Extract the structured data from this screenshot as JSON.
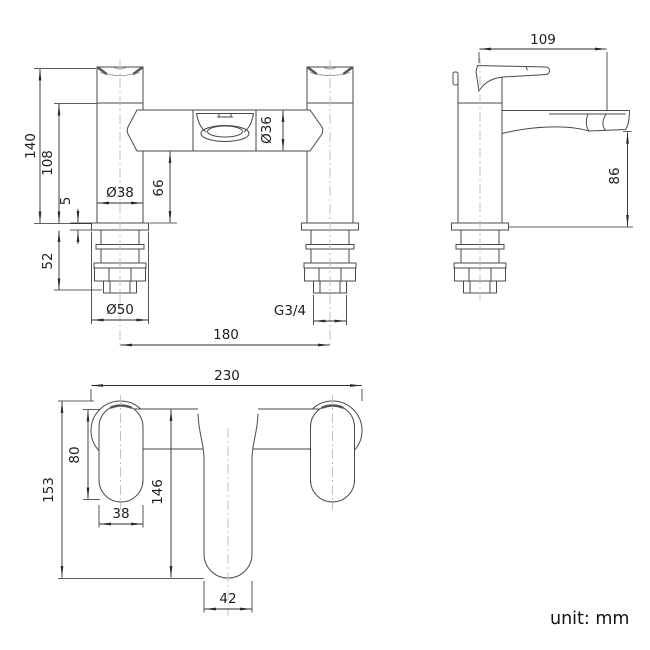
{
  "drawing_type": "tap-technical-drawing",
  "unit_note": "unit: mm",
  "colors": {
    "background": "#ffffff",
    "outline": "#4a4a4a",
    "dimension": "#2b2b2b",
    "centerline": "#bcbcbc",
    "text": "#1c1c1c"
  },
  "views": {
    "front": {
      "labels": {
        "total_height": "140",
        "body_height": "108",
        "deck_plate_thickness": "5",
        "shank_length": "52",
        "pillar_diameter": "Ø38",
        "under_body_height": "66",
        "body_diameter": "Ø36",
        "flange_diameter": "Ø50",
        "thread_size": "G3/4",
        "tap_centres": "180"
      }
    },
    "side": {
      "labels": {
        "spout_reach": "109",
        "spout_outlet_height": "86"
      }
    },
    "plan": {
      "labels": {
        "overall_width": "230",
        "handle_length": "80",
        "overall_depth": "153",
        "handle_width": "38",
        "spout_projection": "146",
        "spout_width": "42"
      }
    }
  }
}
